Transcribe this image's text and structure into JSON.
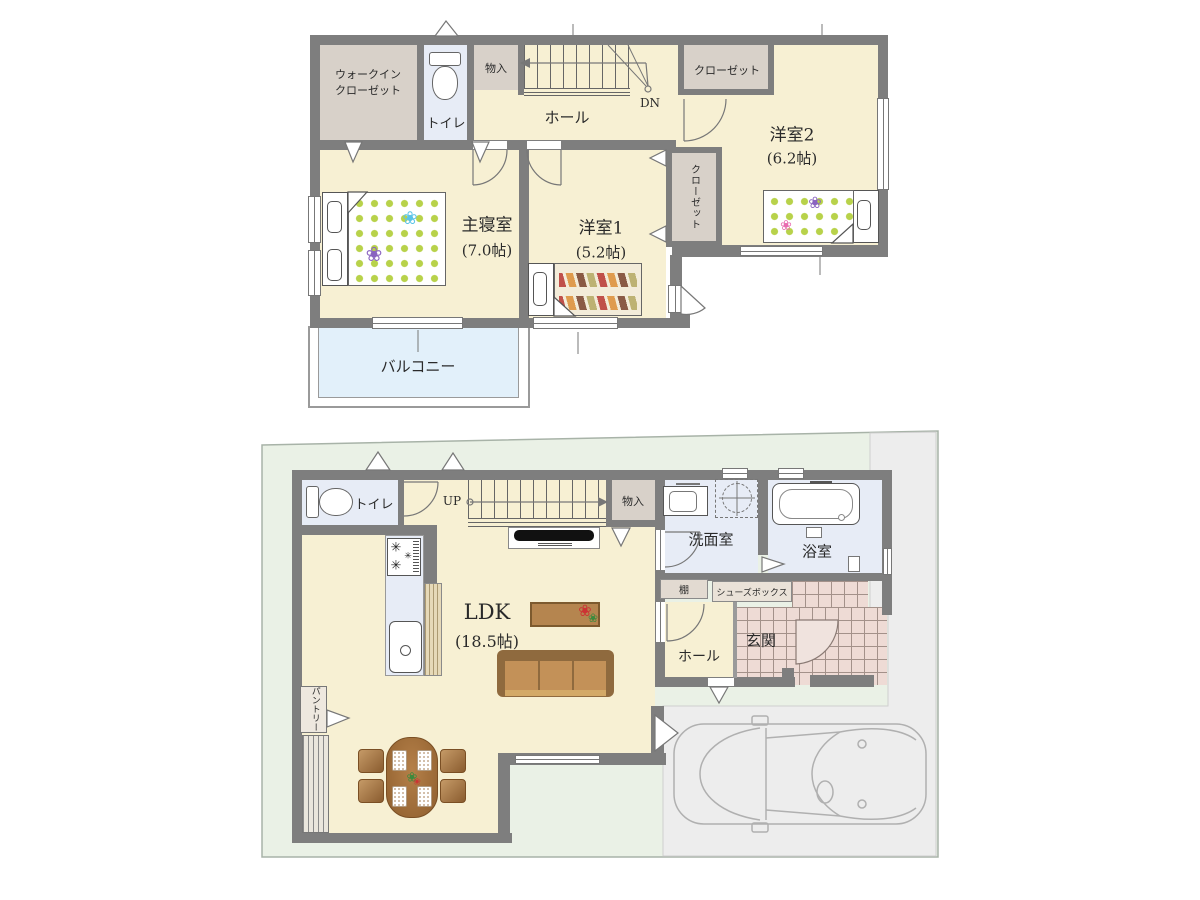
{
  "floor2": {
    "wic_line1": "ウォークイン",
    "wic_line2": "クローゼット",
    "toilet": "トイレ",
    "storage": "物入",
    "hall": "ホール",
    "dn": "DN",
    "closet_top": "クローゼット",
    "closet_side": "クローゼット",
    "room2_name": "洋室2",
    "room2_size": "(6.2帖)",
    "master_name": "主寝室",
    "master_size": "(7.0帖)",
    "room1_name": "洋室1",
    "room1_size": "(5.2帖)",
    "balcony": "バルコニー"
  },
  "floor1": {
    "toilet": "トイレ",
    "up": "UP",
    "storage": "物入",
    "washroom": "洗面室",
    "bath": "浴室",
    "shelf": "棚",
    "shoebox": "シューズボックス",
    "hall": "ホール",
    "entrance": "玄関",
    "ldk_name": "LDK",
    "ldk_size": "(18.5帖)",
    "pantry": "パントリー"
  },
  "icons": {
    "flower": "❀",
    "burner": "✳"
  },
  "colors": {
    "wall": "#7e7e7e",
    "floor_cream": "#f7f0d3",
    "closet_beige": "#d8d1c9",
    "wet_blue": "#e7ecf6",
    "balcony_blue": "#e2f0fa",
    "site_green": "#eaf1e6",
    "driveway_gray": "#ededed",
    "tile_pink": "#eedbd5",
    "dot_green": "#b8d24a",
    "sofa_brown": "#c39158",
    "table_brown": "#b5854f"
  }
}
